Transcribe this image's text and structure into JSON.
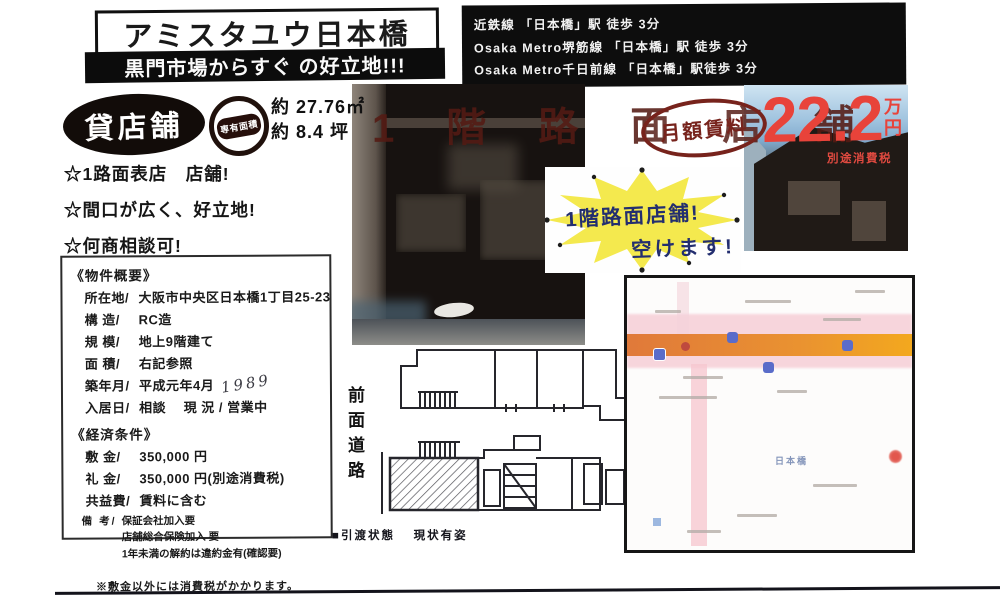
{
  "header": {
    "title": "アミスタユウ日本橋",
    "subtitle": "黒門市場からすぐ の好立地!!!"
  },
  "access": {
    "lines": [
      "近鉄線  「日本橋」駅 徒歩 3分",
      "Osaka Metro堺筋線  「日本橋」駅 徒歩 3分",
      "Osaka Metro千日前線 「日本橋」駅徒歩 3分"
    ]
  },
  "badges": {
    "kashitenpo": "貸店舗",
    "senyu_menseki": "専有面積",
    "area_m2": "約 27.76㎡",
    "area_tsubo": "約 8.4 坪"
  },
  "highlights": {
    "line1": "☆1路面表店　店舗!",
    "line2": "☆間口が広く、好立地!",
    "line3": "☆何商相談可!"
  },
  "rent": {
    "label": "月額賃料",
    "amount": "22.2",
    "unit": "万円",
    "tax_note": "別途消費税"
  },
  "photo_overlay": "1階路面店舗",
  "starburst": {
    "line1": "1階路面店舗!",
    "line2": "空けます!"
  },
  "overview": {
    "heading": "《物件概要》",
    "rows": [
      {
        "label": "所在地/",
        "value": "大阪市中央区日本橋1丁目25-23"
      },
      {
        "label": "構 造/",
        "value": "RC造"
      },
      {
        "label": "規 模/",
        "value": "地上9階建て"
      },
      {
        "label": "面 積/",
        "value": "右記参照"
      },
      {
        "label": "築年月/",
        "value": "平成元年4月",
        "handwritten": "1989"
      },
      {
        "label": "入居日/",
        "value": "相談　 現 況 / 営業中"
      }
    ]
  },
  "economics": {
    "heading": "《経済条件》",
    "rows": [
      {
        "label": "敷 金/",
        "value": "350,000 円"
      },
      {
        "label": "礼 金/",
        "value": "350,000 円(別途消費税)"
      },
      {
        "label": "共益費/",
        "value": "賃料に含む"
      }
    ],
    "remarks_label": "備 考/",
    "remarks": {
      "line1": "保証会社加入要",
      "line2": "店舗総合保険加入 要",
      "line3": "1年未満の解約は違約金有(確認要)"
    },
    "note": "※敷金以外には消費税がかかります。"
  },
  "plan": {
    "road_label": "前面道路",
    "handover": "■引渡状態　 現状有姿"
  },
  "map": {
    "station_label": "日本橋"
  },
  "colors": {
    "accent_red": "#e8433a",
    "maroon": "#541a13",
    "star_yellow": "#f4e94e",
    "marker_navy": "#232e6f",
    "road_orange": "#ea9330",
    "map_pink": "#f6ccd5"
  }
}
